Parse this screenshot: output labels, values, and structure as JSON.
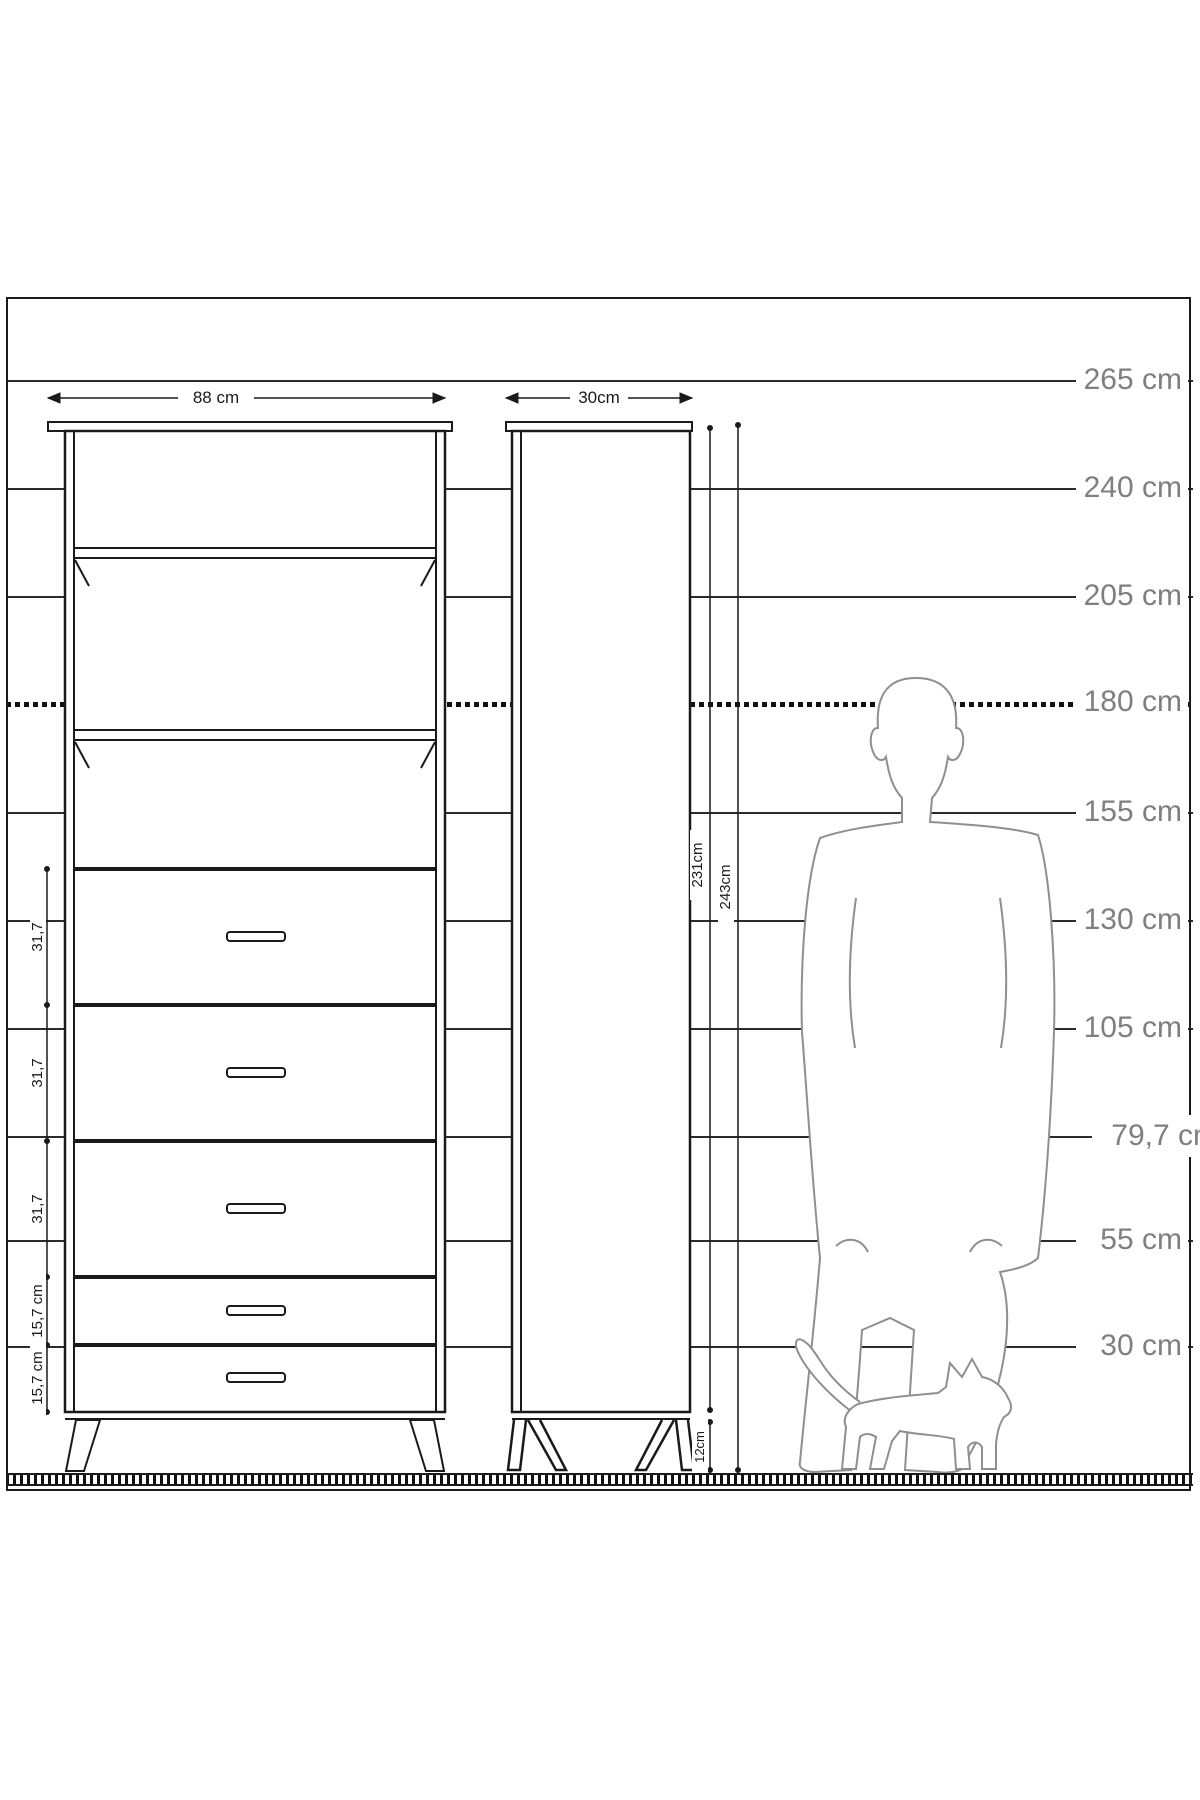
{
  "height_ruler": {
    "unit": "cm",
    "labels": [
      "265 cm",
      "240 cm",
      "205 cm",
      "180 cm",
      "155 cm",
      "130 cm",
      "105 cm",
      "79,7 cm",
      "55 cm",
      "30 cm"
    ]
  },
  "front_view": {
    "width_label": "88 cm",
    "shelf_count": 3,
    "drawer_count": 5,
    "drawer_dims": [
      "31,7",
      "31,7",
      "31,7",
      "15,7 cm",
      "15,7 cm"
    ]
  },
  "side_view": {
    "depth_label": "30cm",
    "body_height_label": "231cm",
    "total_height_label": "243cm",
    "leg_height_label": "12cm"
  },
  "figures": {
    "man": "man-silhouette-180cm",
    "cat": "cat-silhouette"
  },
  "colors": {
    "line": "#1a1a1a",
    "ruler_line": "#2b2b2b",
    "ruler_label": "#7f7f7f",
    "silhouette": "#8f8f8f",
    "background": "#ffffff"
  }
}
